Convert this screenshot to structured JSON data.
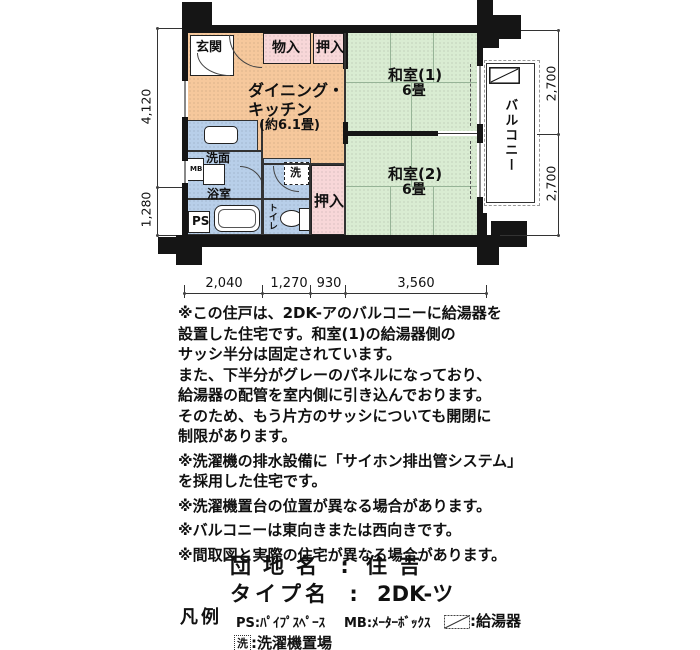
{
  "plan": {
    "rooms": {
      "genkan": "玄関",
      "mono_ire": "物入",
      "oshiire_top": "押入",
      "dk_line1": "ダイニング・",
      "dk_line2": "キッチン",
      "dk_size": "(約6.1畳)",
      "washitsu1_name": "和室(1)",
      "washitsu1_size": "6畳",
      "washitsu2_name": "和室(2)",
      "washitsu2_size": "6畳",
      "balcony": "バルコニー",
      "senmen": "洗面",
      "yokushitsu": "浴室",
      "sen": "洗",
      "toilet": "トイレ",
      "oshiire_bottom": "押入",
      "ps": "PS",
      "mb": "MB"
    },
    "dimensions": {
      "left_top": "4,120",
      "left_bottom": "1,280",
      "right_top": "2,700",
      "right_bottom": "2,700",
      "bottom": [
        "2,040",
        "1,270",
        "930",
        "3,560"
      ]
    }
  },
  "notes": {
    "paragraphs": [
      {
        "lines": [
          "※この住戸は、2DK-アのバルコニーに給湯器を",
          "設置した住宅です。和室(1)の給湯器側の",
          "サッシ半分は固定されています。",
          "また、下半分がグレーのパネルになっており、",
          "給湯器の配管を室内側に引き込んでおります。",
          "そのため、もう片方のサッシについても開閉に",
          "制限があります。"
        ]
      },
      {
        "lines": [
          "※洗濯機の排水設備に「サイホン排出管システム」",
          "を採用した住宅です。"
        ]
      },
      {
        "lines": [
          "※洗濯機置台の位置が異なる場合があります。"
        ]
      },
      {
        "lines": [
          "※バルコニーは東向きまたは西向きです。"
        ]
      },
      {
        "lines": [
          "※間取図と実際の住宅が異なる場合があります。"
        ]
      }
    ]
  },
  "titles": {
    "danchi_label": "団地名",
    "separator": ":",
    "danchi_value": "住吉",
    "type_label": "タイプ名",
    "type_value": "2DK-ツ"
  },
  "legend": {
    "heading": "凡例",
    "ps_item": "PS:ﾊﾟｲﾌﾟｽﾍﾟｰｽ",
    "mb_item": "MB:ﾒｰﾀｰﾎﾞｯｸｽ",
    "heater_label": ":給湯器",
    "washer_symbol": "洗",
    "washer_label": ":洗濯機置場"
  },
  "colors": {
    "dk_orange": "#F6C89C",
    "closet_pink": "#F8D7D8",
    "tatami_green": "#D9ECD2",
    "wet_blue": "#B8CFE9",
    "wall_black": "#151515"
  }
}
